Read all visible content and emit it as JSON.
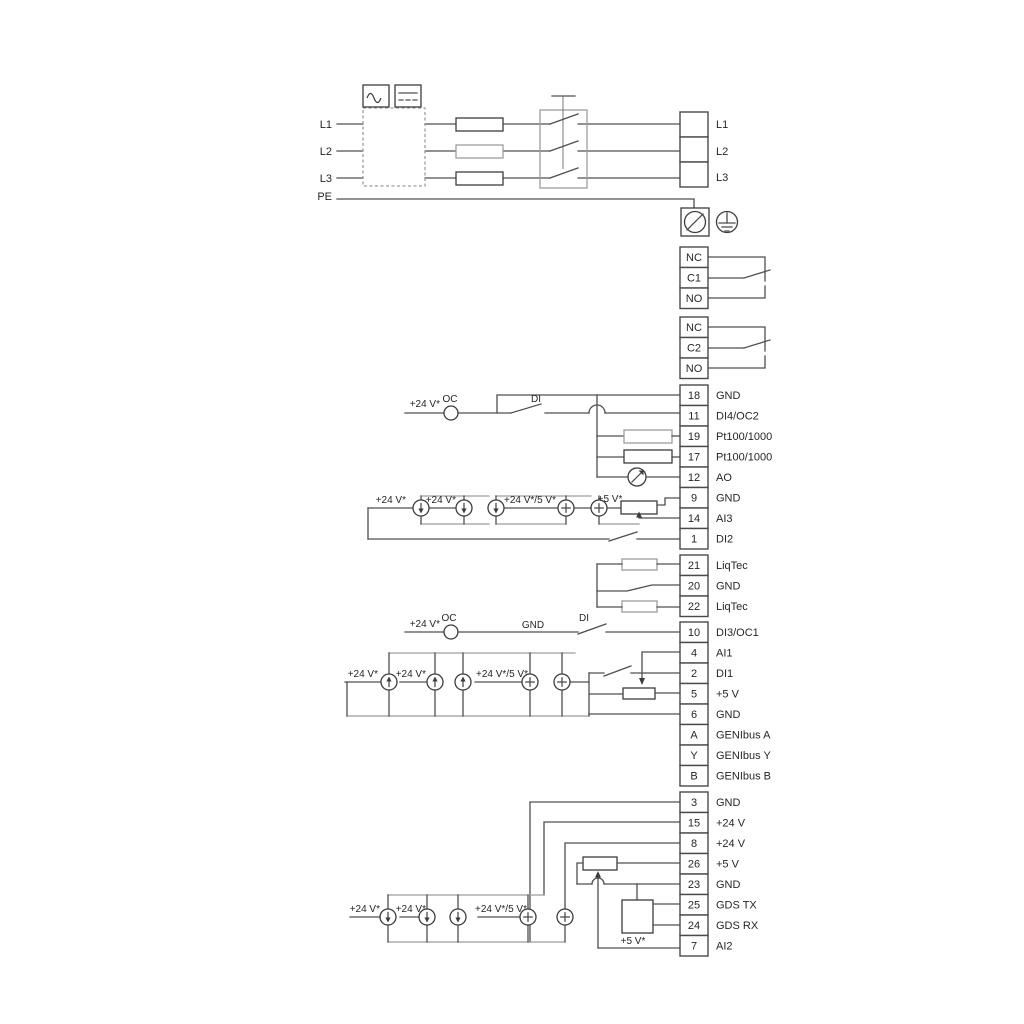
{
  "diagram": {
    "power_input": {
      "left_labels": [
        "L1",
        "L2",
        "L3",
        "PE"
      ],
      "output_terminals": [
        "L1",
        "L2",
        "L3"
      ]
    },
    "relay_blocks": [
      {
        "terminals": [
          "NC",
          "C1",
          "NO"
        ]
      },
      {
        "terminals": [
          "NC",
          "C2",
          "NO"
        ]
      }
    ],
    "terminal_groups": [
      {
        "name": "io-top",
        "terminals": [
          {
            "pin": "18",
            "label": "GND"
          },
          {
            "pin": "11",
            "label": "DI4/OC2"
          },
          {
            "pin": "19",
            "label": "Pt100/1000"
          },
          {
            "pin": "17",
            "label": "Pt100/1000"
          },
          {
            "pin": "12",
            "label": "AO"
          },
          {
            "pin": "9",
            "label": "GND"
          },
          {
            "pin": "14",
            "label": "AI3"
          },
          {
            "pin": "1",
            "label": "DI2"
          }
        ]
      },
      {
        "name": "liqtec",
        "terminals": [
          {
            "pin": "21",
            "label": "LiqTec"
          },
          {
            "pin": "20",
            "label": "GND"
          },
          {
            "pin": "22",
            "label": "LiqTec"
          }
        ]
      },
      {
        "name": "io-mid",
        "terminals": [
          {
            "pin": "10",
            "label": "DI3/OC1"
          },
          {
            "pin": "4",
            "label": "AI1"
          },
          {
            "pin": "2",
            "label": "DI1"
          },
          {
            "pin": "5",
            "label": "+5 V"
          },
          {
            "pin": "6",
            "label": "GND"
          },
          {
            "pin": "A",
            "label": "GENIbus A"
          },
          {
            "pin": "Y",
            "label": "GENIbus Y"
          },
          {
            "pin": "B",
            "label": "GENIbus B"
          }
        ]
      },
      {
        "name": "io-bottom",
        "terminals": [
          {
            "pin": "3",
            "label": "GND"
          },
          {
            "pin": "15",
            "label": "+24 V"
          },
          {
            "pin": "8",
            "label": "+24 V"
          },
          {
            "pin": "26",
            "label": "+5 V"
          },
          {
            "pin": "23",
            "label": "GND"
          },
          {
            "pin": "25",
            "label": "GDS TX"
          },
          {
            "pin": "24",
            "label": "GDS RX"
          },
          {
            "pin": "7",
            "label": "AI2"
          }
        ]
      }
    ],
    "annotations": {
      "plus24": "+24 V*",
      "plus24or5": "+24 V*/5 V*",
      "plus5": "+5 V*",
      "oc": "OC",
      "di": "DI",
      "gnd": "GND"
    },
    "colors": {
      "wire": "#4f4f4f",
      "rail": "#9d9d9d",
      "text": "#262626",
      "background": "#ffffff"
    }
  }
}
